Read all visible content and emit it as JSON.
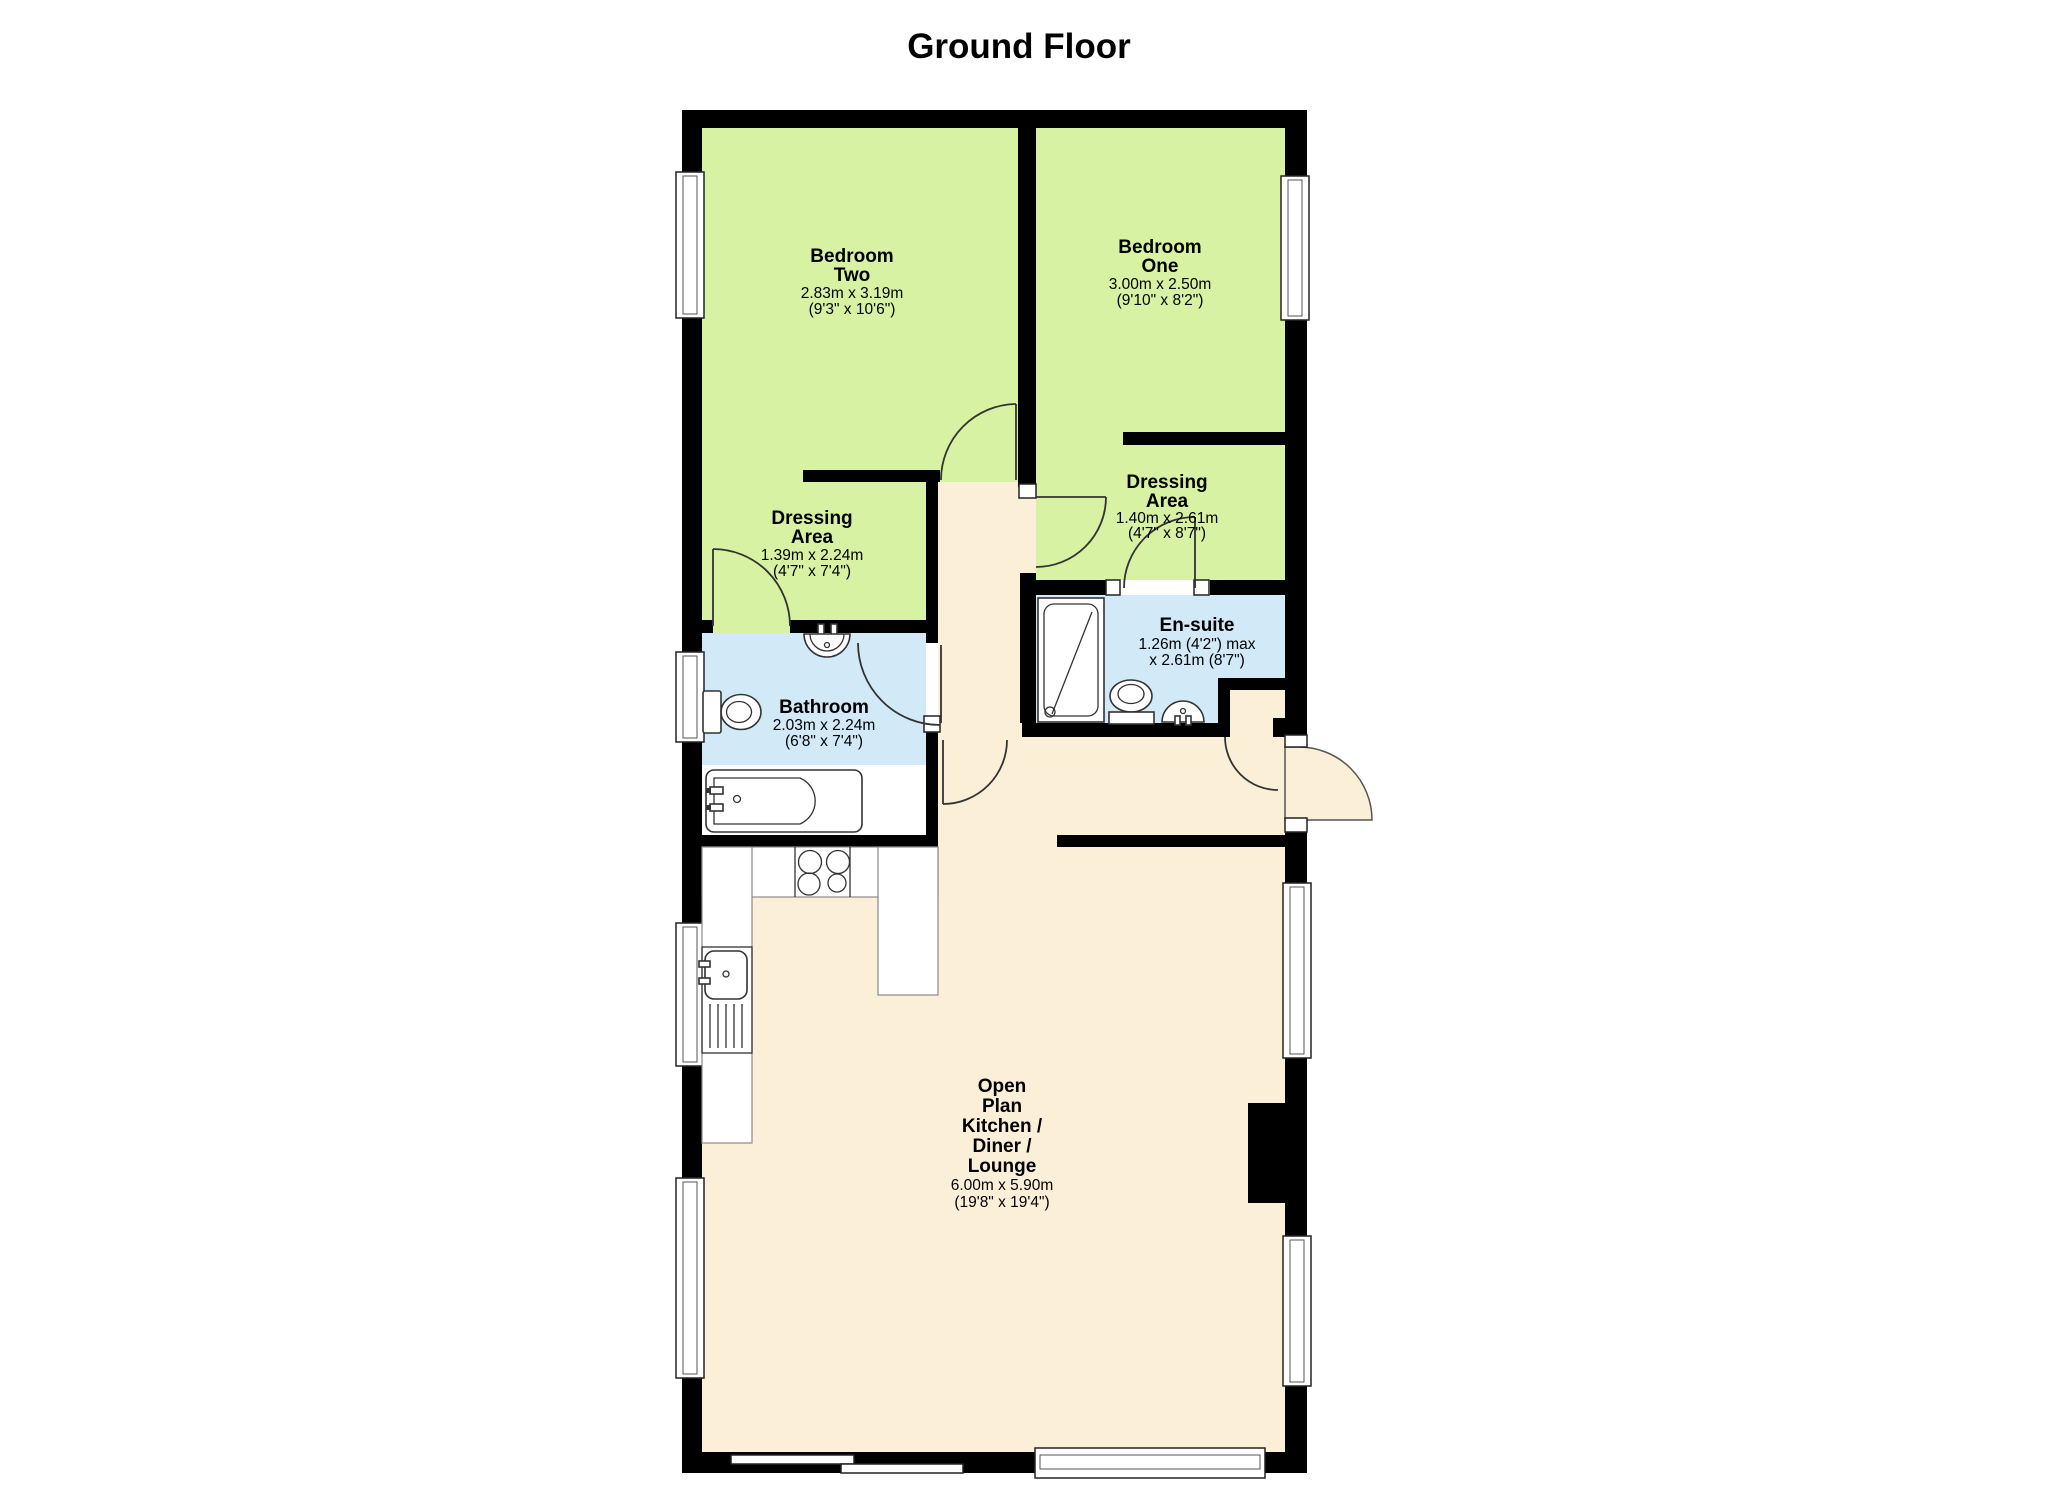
{
  "title": "Ground Floor",
  "colors": {
    "room_green": "#d6f2a2",
    "room_blue": "#d2e9f7",
    "floor_cream": "#fcefd8",
    "wall": "#000000"
  },
  "rooms": {
    "bedroom_two": {
      "name1": "Bedroom",
      "name2": "Two",
      "metric": "2.83m x 3.19m",
      "imperial": "(9'3\" x 10'6\")"
    },
    "bedroom_one": {
      "name1": "Bedroom",
      "name2": "One",
      "metric": "3.00m x 2.50m",
      "imperial": "(9'10\" x 8'2\")"
    },
    "dressing_left": {
      "name1": "Dressing",
      "name2": "Area",
      "metric": "1.39m x 2.24m",
      "imperial": "(4'7\" x 7'4\")"
    },
    "dressing_right": {
      "name1": "Dressing",
      "name2": "Area",
      "metric": "1.40m x 2.61m",
      "imperial": "(4'7\" x 8'7\")"
    },
    "ensuite": {
      "name1": "En-suite",
      "metric": "1.26m (4'2\") max",
      "imperial": "x 2.61m (8'7\")"
    },
    "bathroom": {
      "name1": "Bathroom",
      "metric": "2.03m x 2.24m",
      "imperial": "(6'8\" x 7'4\")"
    },
    "open_plan": {
      "name1": "Open",
      "name2": "Plan",
      "name3": "Kitchen /",
      "name4": "Diner /",
      "name5": "Lounge",
      "metric": "6.00m x 5.90m",
      "imperial": "(19'8\" x 19'4\")"
    }
  }
}
